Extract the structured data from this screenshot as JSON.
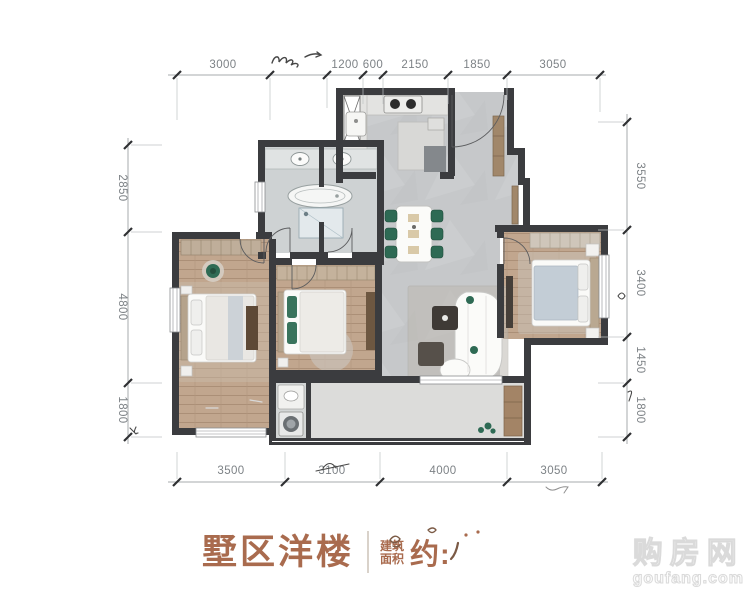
{
  "dimensions": {
    "top": [
      {
        "label": "3000"
      },
      {
        "label": "",
        "obscured": true
      },
      {
        "label": "1200"
      },
      {
        "label": "600"
      },
      {
        "label": "2150"
      },
      {
        "label": "1850"
      },
      {
        "label": "3050"
      }
    ],
    "left": [
      {
        "label": "2850"
      },
      {
        "label": "4800"
      },
      {
        "label": "1800"
      }
    ],
    "right": [
      {
        "label": "3550"
      },
      {
        "label": "3400"
      },
      {
        "label": "1450"
      },
      {
        "label": "1800"
      }
    ],
    "bottom": [
      {
        "label": "3500"
      },
      {
        "label": "3100"
      },
      {
        "label": "4000"
      },
      {
        "label": "3050"
      }
    ]
  },
  "caption": {
    "title": "墅区洋楼",
    "area_label_top": "建筑",
    "area_label_bottom": "面积",
    "area_prefix": "约:",
    "area_value": ""
  },
  "watermark": {
    "name_cn": "购房网",
    "domain": "goufang.com"
  },
  "colors": {
    "wall": "#3b3c3f",
    "tile_floor": "#c6c8ca",
    "wood_floor": "#c1a68e",
    "bath_floor": "#ced2d3",
    "balcony_floor": "#dcdcda",
    "accent_green": "#2e6a54",
    "caption_brown": "#a96b4e",
    "dim_text": "#7d8286"
  }
}
